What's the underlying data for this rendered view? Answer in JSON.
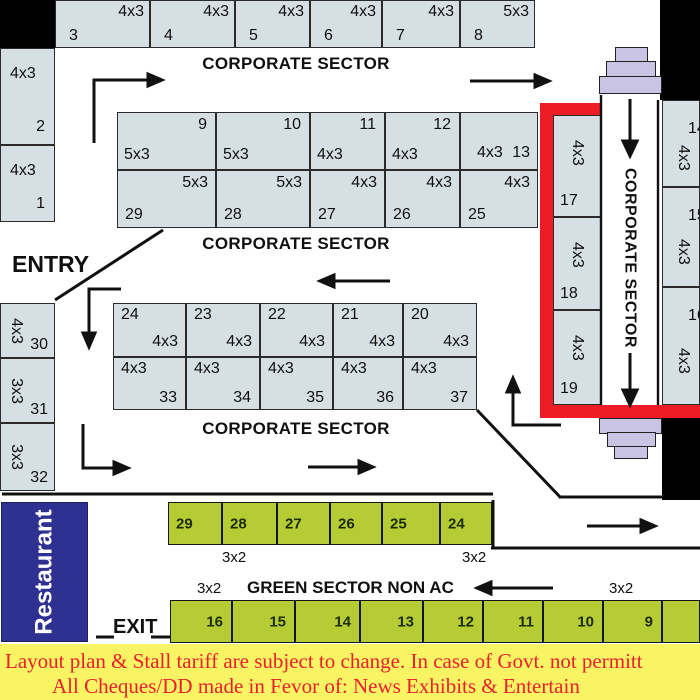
{
  "sections": {
    "corporate_top": "CORPORATE SECTOR",
    "corporate_middle": "CORPORATE SECTOR",
    "corporate_lower": "CORPORATE SECTOR",
    "corporate_corridor": "CORPORATE SECTOR",
    "green_sector": "GREEN SECTOR NON AC"
  },
  "labels": {
    "entry": "ENTRY",
    "exit": "EXIT",
    "restaurant": "Restaurant",
    "green_top_size_left": "3x2",
    "green_top_size_right": "3x2",
    "green_bottom_size_left": "3x2",
    "green_bottom_size_right": "3x2"
  },
  "stalls": {
    "top_row": [
      {
        "no": "3",
        "size": "4x3"
      },
      {
        "no": "4",
        "size": "4x3"
      },
      {
        "no": "5",
        "size": "4x3"
      },
      {
        "no": "6",
        "size": "4x3"
      },
      {
        "no": "7",
        "size": "4x3"
      },
      {
        "no": "8",
        "size": "5x3"
      }
    ],
    "left_upper": [
      {
        "no": "2",
        "size": "4x3"
      },
      {
        "no": "1",
        "size": "4x3"
      }
    ],
    "block1_top": [
      {
        "no": "9",
        "size": "5x3"
      },
      {
        "no": "10",
        "size": "5x3"
      },
      {
        "no": "11",
        "size": "4x3"
      },
      {
        "no": "12",
        "size": "4x3"
      },
      {
        "no": "13",
        "size": "4x3"
      }
    ],
    "block1_bottom": [
      {
        "no": "29",
        "size": "5x3"
      },
      {
        "no": "28",
        "size": "5x3"
      },
      {
        "no": "27",
        "size": "4x3"
      },
      {
        "no": "26",
        "size": "4x3"
      },
      {
        "no": "25",
        "size": "4x3"
      }
    ],
    "block2_top": [
      {
        "no": "24",
        "size": "4x3"
      },
      {
        "no": "23",
        "size": "4x3"
      },
      {
        "no": "22",
        "size": "4x3"
      },
      {
        "no": "21",
        "size": "4x3"
      },
      {
        "no": "20",
        "size": "4x3"
      }
    ],
    "block2_bottom": [
      {
        "no": "33",
        "size": "4x3"
      },
      {
        "no": "34",
        "size": "4x3"
      },
      {
        "no": "35",
        "size": "4x3"
      },
      {
        "no": "36",
        "size": "4x3"
      },
      {
        "no": "37",
        "size": "4x3"
      }
    ],
    "left_lower": [
      {
        "no": "30",
        "size": "4x3"
      },
      {
        "no": "31",
        "size": "3x3"
      },
      {
        "no": "32",
        "size": "3x3"
      }
    ],
    "corporate_right": [
      {
        "no": "17",
        "size": "4x3"
      },
      {
        "no": "18",
        "size": "4x3"
      },
      {
        "no": "19",
        "size": "4x3"
      }
    ],
    "right_edge": [
      {
        "no": "14",
        "size": "4x3"
      },
      {
        "no": "15",
        "size": "4x3"
      },
      {
        "no": "16",
        "size": "4x3"
      }
    ],
    "green_top": [
      {
        "no": "29"
      },
      {
        "no": "28"
      },
      {
        "no": "27"
      },
      {
        "no": "26"
      },
      {
        "no": "25"
      },
      {
        "no": "24"
      }
    ],
    "green_bottom": [
      {
        "no": "16"
      },
      {
        "no": "15"
      },
      {
        "no": "14"
      },
      {
        "no": "13"
      },
      {
        "no": "12"
      },
      {
        "no": "11"
      },
      {
        "no": "10"
      },
      {
        "no": "9"
      },
      {
        "no": ""
      }
    ]
  },
  "notice": {
    "line1": "Layout plan & Stall tariff are subject to change. In case of Govt. not permitt",
    "line2": "All Cheques/DD made in Fevor of: News Exhibits & Entertain"
  },
  "colors": {
    "stall_fill": "#d6e0e4",
    "green_fill": "#b5cc35",
    "accent_red": "#ee1c24",
    "restaurant_blue": "#2e3192",
    "notice_bg": "#f8f464",
    "notice_text": "#e8212e",
    "podium_lavender": "#c9c3e4"
  }
}
